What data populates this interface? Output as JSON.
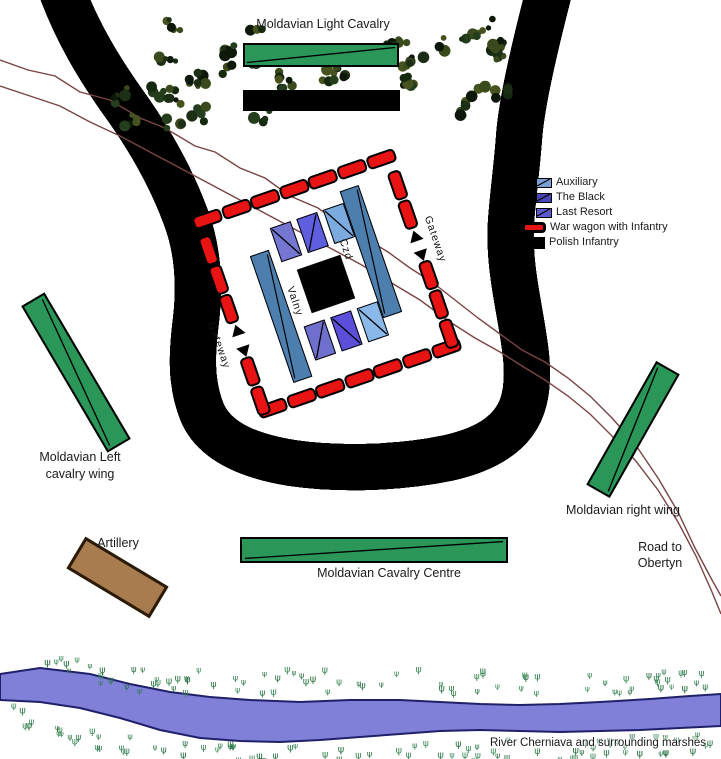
{
  "labels": {
    "light_cavalry": "Moldavian Light Cavalry",
    "left_wing_line1": "Moldavian Left",
    "left_wing_line2": "cavalry wing",
    "right_wing": "Moldavian right wing",
    "road_line1": "Road to",
    "road_line2": "Obertyn",
    "artillery": "Artillery",
    "cavalry_centre": "Moldavian Cavalry Centre",
    "river": "River Cherniava and surrounding marshes",
    "gateway_left": "Gateway",
    "gateway_right": "Gateway",
    "fort_bar_left": "Valny",
    "fort_bar_right": "Czd"
  },
  "legend": {
    "items": [
      {
        "label": "Auxiliary",
        "type": "unit",
        "color": "#7a9fd6"
      },
      {
        "label": "The Black",
        "type": "unit",
        "color": "#4646b4"
      },
      {
        "label": "Last Resort",
        "type": "unit",
        "color": "#5b5bd0"
      },
      {
        "label": "War wagon with Infantry",
        "type": "wagon",
        "color": "#e81313"
      },
      {
        "label": "Polish Infantry",
        "type": "infantry",
        "color": "#000000"
      }
    ]
  },
  "fort": {
    "bar_color": "#4d7fae",
    "wagon_color": "#e81313",
    "units": [
      {
        "name": "cavalry-unit-1",
        "color": "#7575d2",
        "diag": "tlbr"
      },
      {
        "name": "cavalry-unit-2",
        "color": "#5e5ede",
        "diag": "bltr"
      },
      {
        "name": "cavalry-unit-3",
        "color": "#7cabe0",
        "diag": "tlbr"
      },
      {
        "name": "cavalry-unit-4",
        "color": "#6f6fcd",
        "diag": "bltr"
      },
      {
        "name": "cavalry-unit-5",
        "color": "#5b4fd9",
        "diag": "tlbr"
      },
      {
        "name": "cavalry-unit-6",
        "color": "#8ab8e8",
        "diag": "tlbr"
      }
    ]
  },
  "colors": {
    "moldavian_green": "#2a9758",
    "artillery_brown": "#a87c4f",
    "river_blue": "#8080d8",
    "road_brown": "#7a4444",
    "polish_black": "#000000"
  }
}
